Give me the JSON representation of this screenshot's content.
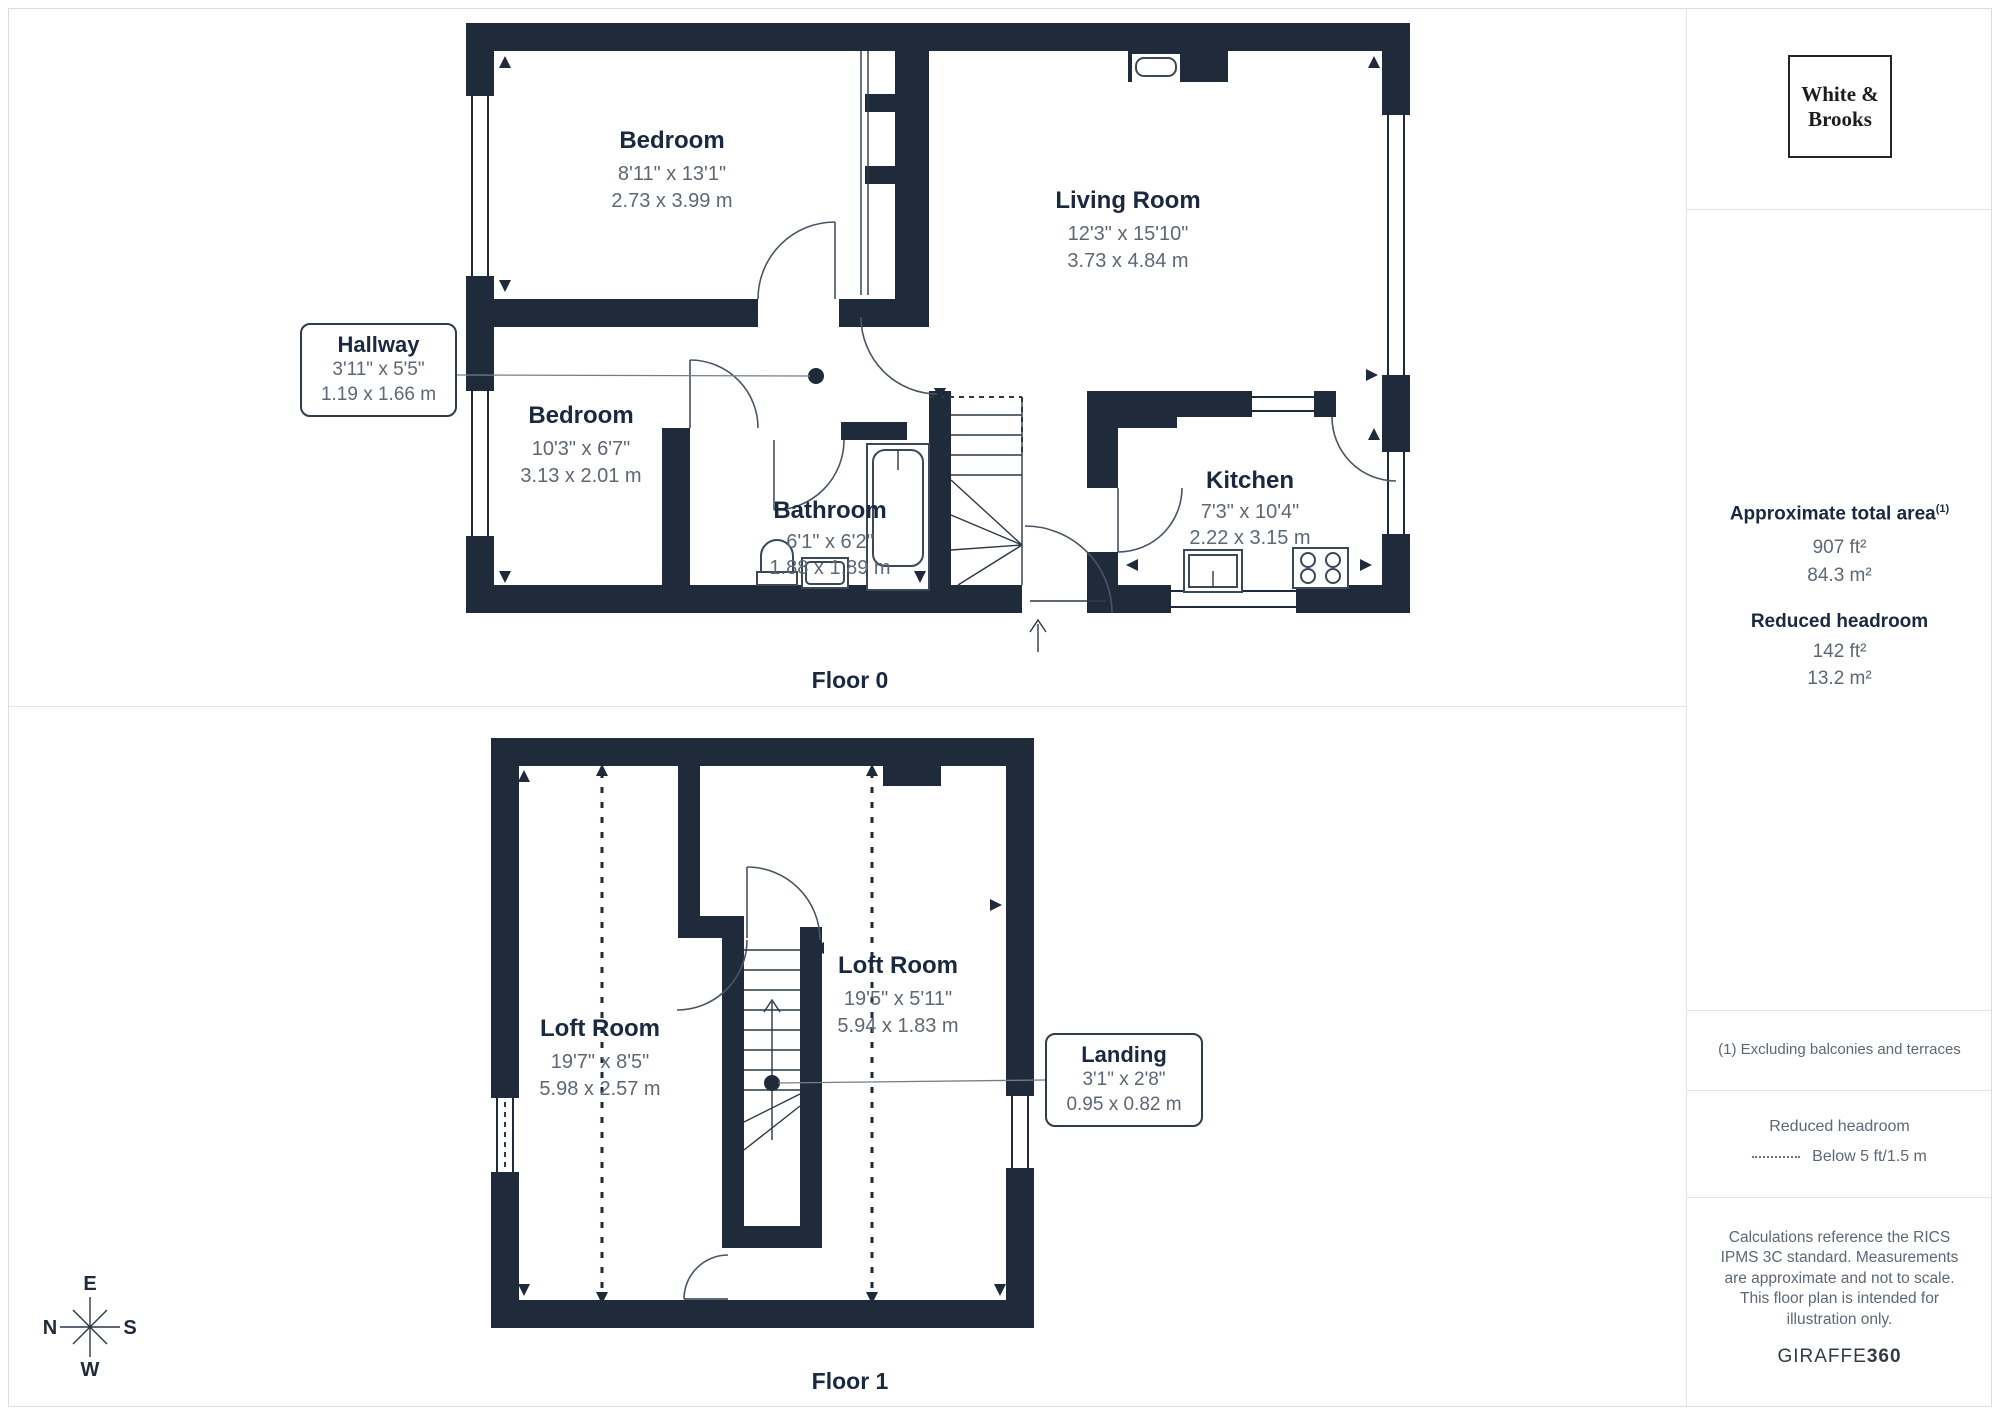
{
  "logo": {
    "line1": "White &",
    "line2": "Brooks"
  },
  "floor0": {
    "label": "Floor 0",
    "rooms": {
      "bedroom1": {
        "name": "Bedroom",
        "imperial": "8'11\" x 13'1\"",
        "metric": "2.73 x 3.99 m"
      },
      "living": {
        "name": "Living Room",
        "imperial": "12'3\" x 15'10\"",
        "metric": "3.73 x 4.84 m"
      },
      "bedroom2": {
        "name": "Bedroom",
        "imperial": "10'3\" x 6'7\"",
        "metric": "3.13 x 2.01 m"
      },
      "bathroom": {
        "name": "Bathroom",
        "imperial": "6'1\" x 6'2\"",
        "metric": "1.88 x 1.89 m"
      },
      "kitchen": {
        "name": "Kitchen",
        "imperial": "7'3\" x 10'4\"",
        "metric": "2.22 x 3.15 m"
      }
    },
    "callout": {
      "name": "Hallway",
      "imperial": "3'11\" x 5'5\"",
      "metric": "1.19 x 1.66 m"
    }
  },
  "floor1": {
    "label": "Floor 1",
    "rooms": {
      "loft_left": {
        "name": "Loft Room",
        "imperial": "19'7\" x 8'5\"",
        "metric": "5.98 x 2.57 m"
      },
      "loft_right": {
        "name": "Loft Room",
        "imperial": "19'5\" x 5'11\"",
        "metric": "5.94 x 1.83 m"
      }
    },
    "callout": {
      "name": "Landing",
      "imperial": "3'1\" x 2'8\"",
      "metric": "0.95 x 0.82 m"
    }
  },
  "compass": {
    "top": "E",
    "left": "N",
    "right": "S",
    "bottom": "W"
  },
  "sidebar": {
    "total_area_heading": "Approximate total area",
    "total_area_sup": "(1)",
    "total_area_ft": "907 ft²",
    "total_area_m": "84.3 m²",
    "reduced_heading": "Reduced headroom",
    "reduced_ft": "142 ft²",
    "reduced_m": "13.2 m²",
    "footnote": "(1) Excluding balconies and terraces",
    "legend_title": "Reduced headroom",
    "legend_value": "Below 5 ft/1.5 m",
    "disclaimer": "Calculations reference the RICS IPMS 3C standard. Measurements are approximate and not to scale. This floor plan is intended for illustration only.",
    "brand_name": "GIRAFFE",
    "brand_suffix": "360"
  },
  "colors": {
    "wall": "#1f2b3a",
    "heading": "#1b2940",
    "dim_text": "#5d6874",
    "divider": "#e3e3e3"
  }
}
